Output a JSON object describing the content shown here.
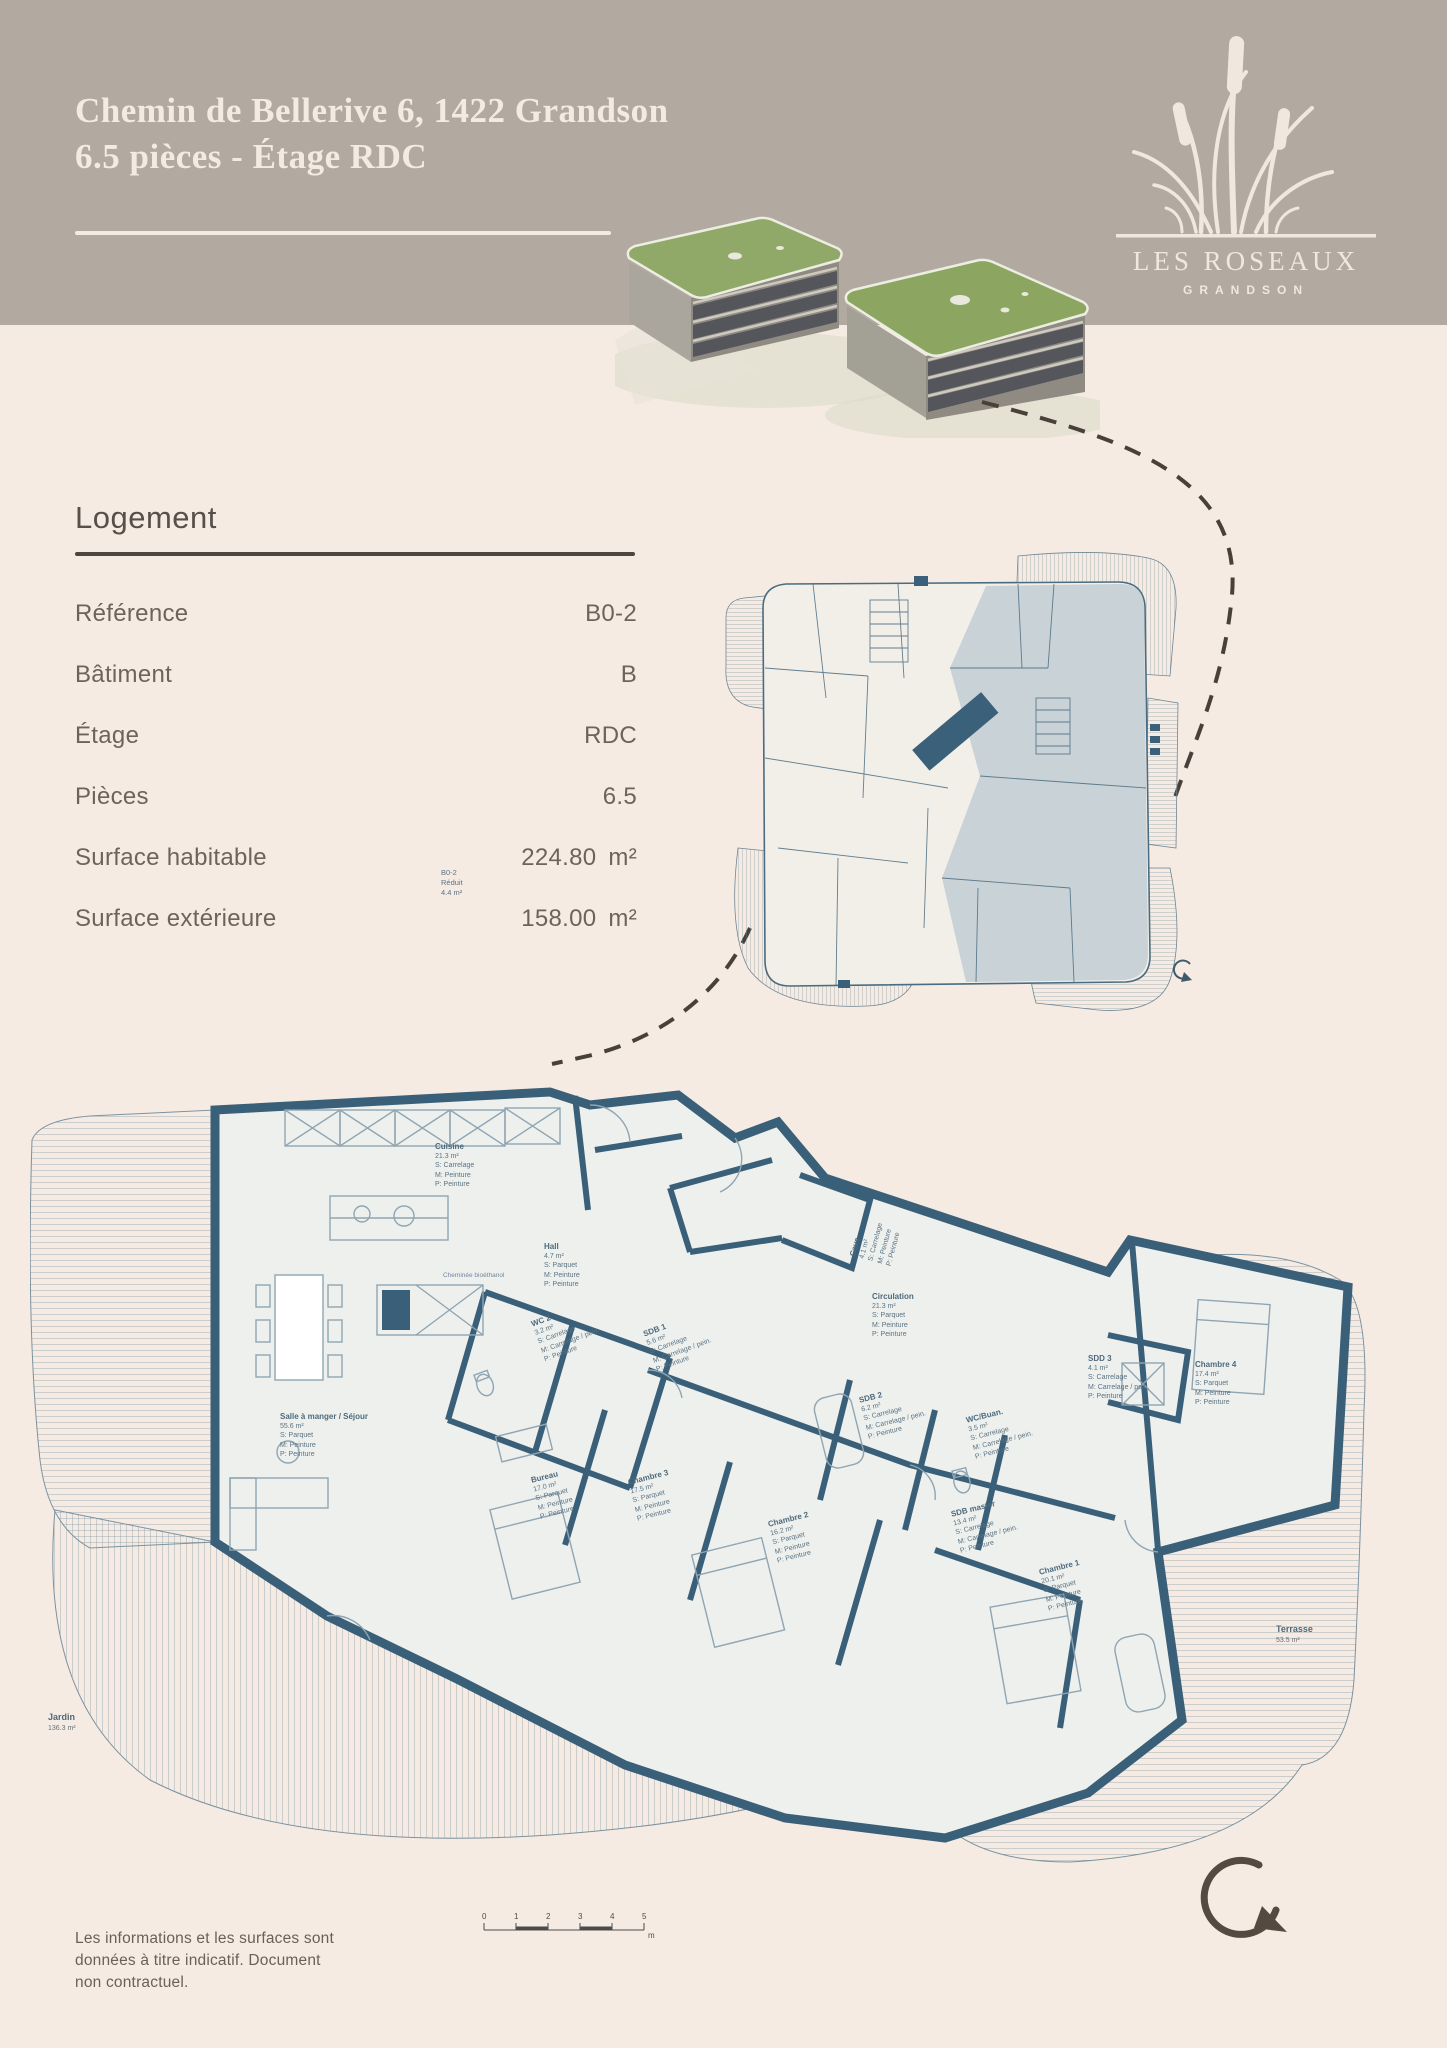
{
  "header": {
    "title_line1": "Chemin de Bellerive 6, 1422 Grandson",
    "title_line2": "6.5 pièces - Étage RDC",
    "band_color": "#b2a9a1"
  },
  "logo": {
    "name": "LES ROSEAUX",
    "subname": "GRANDSON",
    "icon": "reeds-icon",
    "color": "#f0e8df"
  },
  "logement": {
    "title": "Logement",
    "rows": [
      {
        "label": "Référence",
        "value": "B0-2",
        "unit": ""
      },
      {
        "label": "Bâtiment",
        "value": "B",
        "unit": ""
      },
      {
        "label": "Étage",
        "value": "RDC",
        "unit": ""
      },
      {
        "label": "Pièces",
        "value": "6.5",
        "unit": ""
      },
      {
        "label": "Surface habitable",
        "value": "224.80",
        "unit": "m²"
      },
      {
        "label": "Surface extérieure",
        "value": "158.00",
        "unit": "m²"
      }
    ]
  },
  "floorplan": {
    "wall_color": "#3a5f78",
    "highlight_color": "#c9d2d6",
    "rooms": [
      {
        "name": "Salle à manger / Séjour",
        "area": "55.6 m²",
        "s": "S: Parquet",
        "m": "M: Peinture",
        "p": "P: Peinture"
      },
      {
        "name": "Cuisine",
        "area": "21.3 m²",
        "s": "S: Carrelage",
        "m": "M: Peinture",
        "p": "P: Peinture"
      },
      {
        "name": "Cave",
        "area": "4.1 m²",
        "s": "S: Carrelage",
        "m": "M: Peinture",
        "p": "P: Peinture"
      },
      {
        "name": "Hall",
        "area": "4.7 m²",
        "s": "S: Parquet",
        "m": "M: Peinture",
        "p": "P: Peinture"
      },
      {
        "name": "WC 2",
        "area": "3.2 m²",
        "s": "S: Carrelage",
        "m": "M: Carrelage / pein.",
        "p": "P: Peinture"
      },
      {
        "name": "SDB 1",
        "area": "5.6 m²",
        "s": "S: Carrelage",
        "m": "M: Carrelage / pein.",
        "p": "P: Peinture"
      },
      {
        "name": "Bureau",
        "area": "17.0 m²",
        "s": "S: Parquet",
        "m": "M: Peinture",
        "p": "P: Peinture"
      },
      {
        "name": "Chambre 3",
        "area": "17.5 m²",
        "s": "S: Parquet",
        "m": "M: Peinture",
        "p": "P: Peinture"
      },
      {
        "name": "Chambre 2",
        "area": "16.2 m²",
        "s": "S: Parquet",
        "m": "M: Peinture",
        "p": "P: Peinture"
      },
      {
        "name": "SDB 2",
        "area": "6.2 m²",
        "s": "S: Carrelage",
        "m": "M: Carrelage / pein.",
        "p": "P: Peinture"
      },
      {
        "name": "WC/Buan.",
        "area": "3.5 m²",
        "s": "S: Carrelage",
        "m": "M: Carrelage / pein.",
        "p": "P: Peinture"
      },
      {
        "name": "Circulation",
        "area": "21.3 m²",
        "s": "S: Parquet",
        "m": "M: Peinture",
        "p": "P: Peinture"
      },
      {
        "name": "SDD 3",
        "area": "4.1 m²",
        "s": "S: Carrelage",
        "m": "M: Carrelage / pein.",
        "p": "P: Peinture"
      },
      {
        "name": "Chambre 4",
        "area": "17.4 m²",
        "s": "S: Parquet",
        "m": "M: Peinture",
        "p": "P: Peinture"
      },
      {
        "name": "SDB master",
        "area": "13.4 m²",
        "s": "S: Carrelage",
        "m": "M: Carrelage / pein.",
        "p": "P: Peinture"
      },
      {
        "name": "Chambre 1",
        "area": "20.1 m²",
        "s": "S: Parquet",
        "m": "M: Peinture",
        "p": "P: Peinture"
      }
    ],
    "outdoor": {
      "terrasse": {
        "name": "Terrasse",
        "area": "53.5 m²"
      },
      "jardin": {
        "name": "Jardin",
        "area": "136.3 m²"
      }
    },
    "reduit_label": {
      "line1": "B0-2",
      "line2": "Réduit",
      "line3": "4.4 m²"
    },
    "fireplace_note": "Cheminée bioéthanol",
    "unit_reference": "B0-2"
  },
  "scalebar": {
    "ticks": [
      "0",
      "1",
      "2",
      "3",
      "4",
      "5"
    ],
    "unit": "m"
  },
  "footer": {
    "line1": "Les informations et les surfaces sont",
    "line2": "données à titre indicatif. Document",
    "line3": "non contractuel."
  }
}
